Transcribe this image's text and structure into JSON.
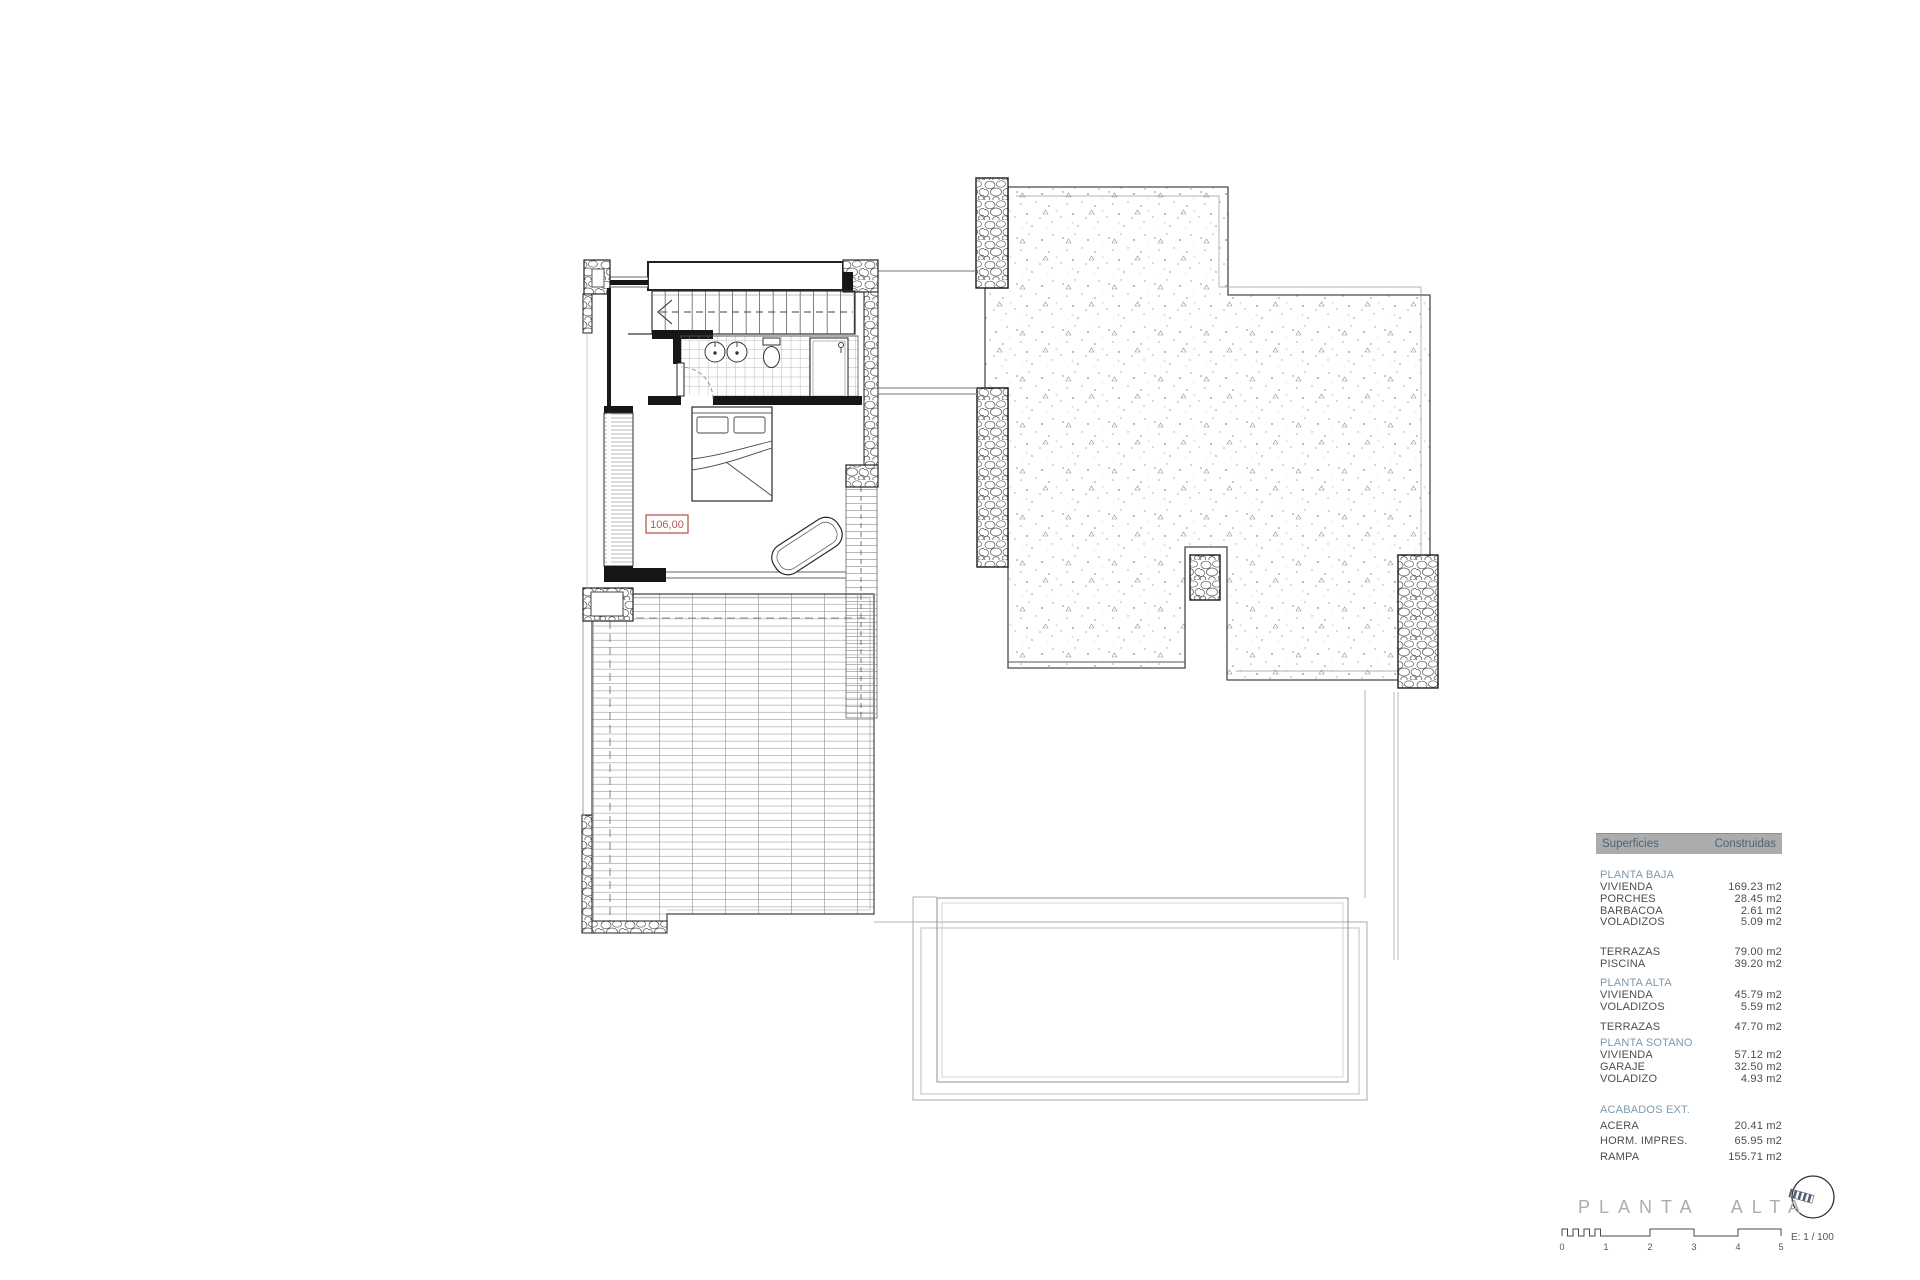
{
  "title": "PLANTA ALTA",
  "plan": {
    "room_label": "106,00"
  },
  "scale": {
    "label": "E: 1 / 100",
    "ticks": [
      "0",
      "1",
      "2",
      "3",
      "4",
      "5"
    ]
  },
  "table": {
    "col1": "Superficies",
    "col2": "Construidas",
    "rows": [
      {
        "t": "section",
        "label": "PLANTA BAJA"
      },
      {
        "t": "item",
        "label": "VIVIENDA",
        "value": "169.23 m2"
      },
      {
        "t": "item",
        "label": "PORCHES",
        "value": "28.45 m2"
      },
      {
        "t": "item",
        "label": "BARBACOA",
        "value": "2.61 m2"
      },
      {
        "t": "item",
        "label": "VOLADIZOS",
        "value": "5.09 m2"
      },
      {
        "t": "gap",
        "h": 18
      },
      {
        "t": "item",
        "label": "TERRAZAS",
        "value": "79.00 m2"
      },
      {
        "t": "item",
        "label": "PISCINA",
        "value": "39.20 m2"
      },
      {
        "t": "gap",
        "h": 6
      },
      {
        "t": "section",
        "label": "PLANTA ALTA"
      },
      {
        "t": "item",
        "label": "VIVIENDA",
        "value": "45.79 m2"
      },
      {
        "t": "item",
        "label": "VOLADIZOS",
        "value": "5.59 m2"
      },
      {
        "t": "gap",
        "h": 9
      },
      {
        "t": "item",
        "label": "TERRAZAS",
        "value": "47.70 m2"
      },
      {
        "t": "gap",
        "h": 3
      },
      {
        "t": "section",
        "label": "PLANTA SOTANO"
      },
      {
        "t": "item",
        "label": "VIVIENDA",
        "value": "57.12 m2"
      },
      {
        "t": "item",
        "label": "GARAJE",
        "value": "32.50 m2"
      },
      {
        "t": "item",
        "label": "VOLADIZO",
        "value": "4.93 m2"
      },
      {
        "t": "gap",
        "h": 18
      },
      {
        "t": "section",
        "label": "ACABADOS EXT."
      },
      {
        "t": "gap",
        "h": 4
      },
      {
        "t": "item",
        "label": "ACERA",
        "value": "20.41 m2"
      },
      {
        "t": "gap",
        "h": 4
      },
      {
        "t": "item",
        "label": "HORM. IMPRES.",
        "value": "65.95 m2"
      },
      {
        "t": "gap",
        "h": 4
      },
      {
        "t": "item",
        "label": "RAMPA",
        "value": "155.71 m2"
      }
    ]
  },
  "colors": {
    "accent_red": "#b25a55",
    "section_blue": "#7e99ad",
    "table_header_bg": "#acacac",
    "table_header_fg": "#4f6272"
  }
}
